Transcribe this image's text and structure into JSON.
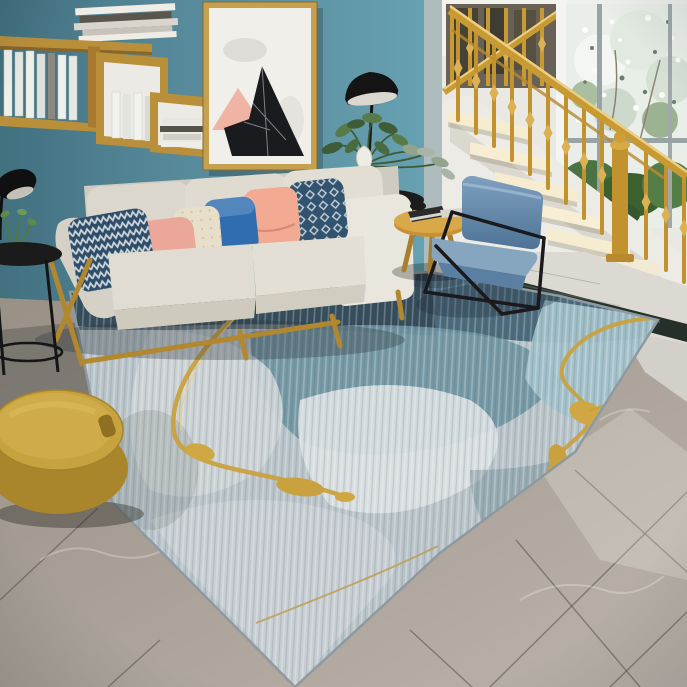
{
  "meta": {
    "description": "Photograph of a bright living room: teal accent wall with wooden wall shelves and abstract triangle art, cream fabric sofa with colorful throw pillows, gold ornate staircase railing beside a garden window, blue accent chair with black metal frame, round wood side table, abstract blue-gray area rug with metallic gold veins on gray marble tile floor, mustard round pouf ottoman",
    "visible_text": []
  },
  "palette": {
    "wall_teal": "#68a2b2",
    "wall_teal_dark": "#41707f",
    "wall_white": "#eae8e3",
    "ceiling_white": "#f4f2ed",
    "step_sunlit": "#f6ecd0",
    "gold": "#c89a34",
    "gold_light": "#eccf82",
    "foliage_green": "#4a7243",
    "sofa_ivory": "#dcd8cd",
    "wood": "#b1882f",
    "pillow_navy": "#2e4d68",
    "pillow_pink": "#eba89a",
    "pillow_cream": "#e7dfc9",
    "pillow_blue": "#2f6cb0",
    "pillow_peach": "#f2ab92",
    "pillow_navy2": "#31536e",
    "chair_blue": "#577fa4",
    "table_wood": "#c89136",
    "pouf_mustard": "#c7a340",
    "pouf_side": "#a9852c",
    "rug_base": "#b9c4c9",
    "rug_dark_blue": "#4a6a7c",
    "rug_teal": "#6e93a1",
    "rug_light_teal": "#a2c1c9",
    "rug_light_gray": "#ccd2d5",
    "rug_gold": "#c9a13e",
    "floor_light": "#bcb4ab",
    "floor_dark": "#999186",
    "white_marble": "#dcd9d2",
    "marble_strip": "#25302a",
    "art_canvas": "#f1efe9",
    "art_frame": "#c5a04e",
    "art_black": "#1a1b1e",
    "art_pink": "#efb4a3",
    "vase_white": "#efece4",
    "lamp_black": "#161618"
  },
  "objects": [
    {
      "name": "teal-accent-wall",
      "label": "Teal painted accent wall"
    },
    {
      "name": "wall-shelf",
      "label": "Staggered wooden wall shelf with white books"
    },
    {
      "name": "book-stack",
      "label": "Stack of books on top of shelf"
    },
    {
      "name": "framed-abstract-art",
      "label": "Framed abstract art with black marble and pink triangles"
    },
    {
      "name": "floor-lamp",
      "label": "Black dome floor lamp"
    },
    {
      "name": "arc-lamp",
      "label": "Black arc lamp at left edge"
    },
    {
      "name": "black-side-table",
      "label": "Round black metal side table with small plant"
    },
    {
      "name": "sofa",
      "label": "Cream three-seat sofa with wood frame"
    },
    {
      "name": "throw-pillows",
      "label": "Throw pillows: navy zigzag, pink, cream, royal blue, peach, navy geometric"
    },
    {
      "name": "rear-plant",
      "label": "Leafy plant arrangement in white gourd vase on black table"
    },
    {
      "name": "staircase",
      "label": "White staircase with sunlit steps"
    },
    {
      "name": "gold-railing",
      "label": "Ornate gold balustrade with twisted knot spindles"
    },
    {
      "name": "garden-window",
      "label": "Large window with blossoming tree and green bushes outside"
    },
    {
      "name": "accent-chair",
      "label": "Slate blue accent chair with thin black metal frame"
    },
    {
      "name": "round-side-table",
      "label": "Round wooden side table with books on top"
    },
    {
      "name": "area-rug",
      "label": "Abstract area rug in blue, gray and teal with metallic gold veins"
    },
    {
      "name": "pouf-ottoman",
      "label": "Round mustard yellow pouf ottoman"
    },
    {
      "name": "marble-tile-floor",
      "label": "Gray marble tile floor with diagonal grout lines"
    },
    {
      "name": "dark-marble-strip",
      "label": "Dark green marble inlay strip at stair base"
    }
  ]
}
